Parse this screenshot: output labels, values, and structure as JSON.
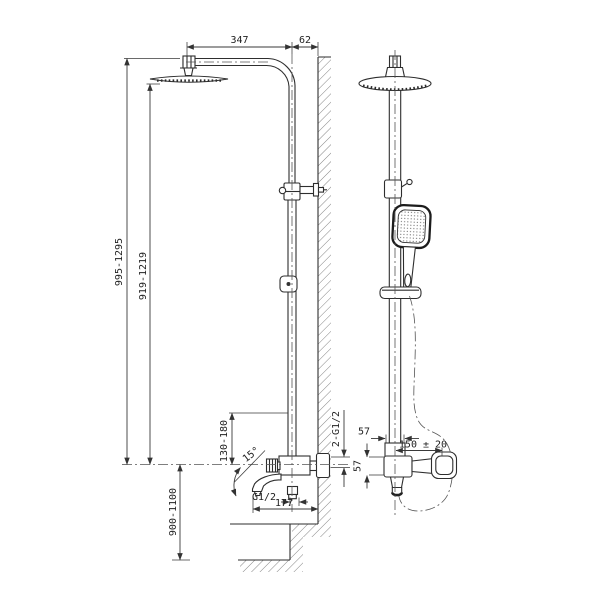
{
  "background": "#ffffff",
  "line_color": "#2e2e2e",
  "dims": {
    "arm_length": "347",
    "wall_offset": "62",
    "height_overall": "995-1295",
    "height_head": "919-1219",
    "riser_adjust": "130-180",
    "spout_angle": "15°",
    "spout_outlet_thread": "G1/2",
    "wall_inlets": "2-G1/2",
    "mixer_height": "900-1100",
    "spout_reach": "177",
    "connector_width": "57",
    "handle_span": "150 ± 20",
    "mixer_body_height": "57"
  }
}
